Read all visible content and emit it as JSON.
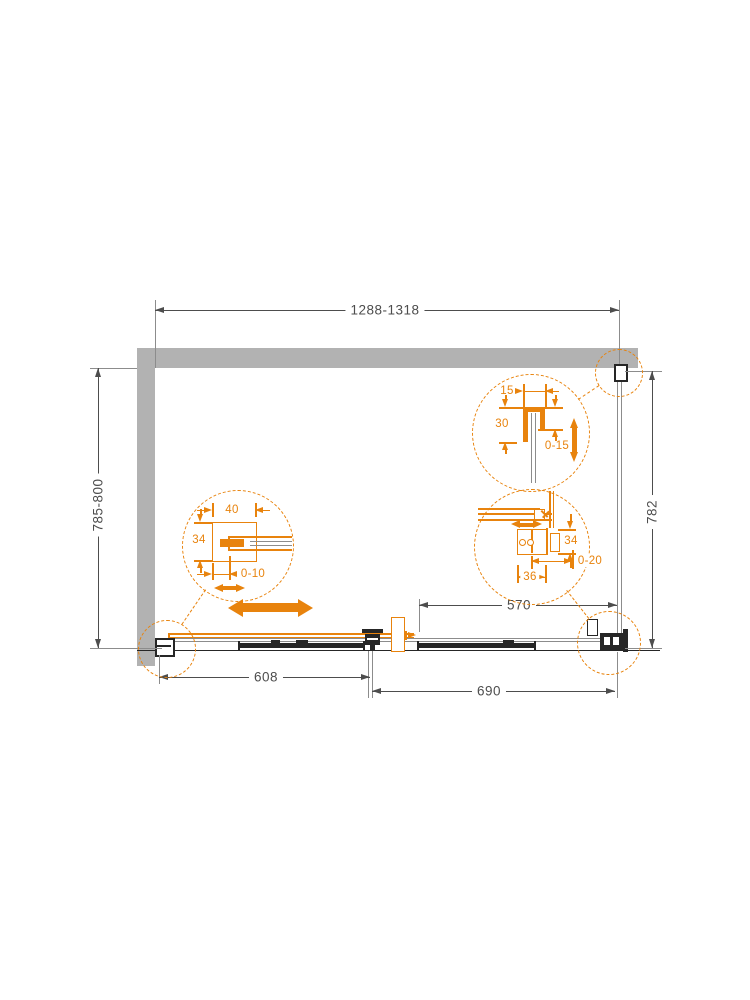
{
  "colors": {
    "accent": "#E8830D",
    "wall": "#B2B2B2",
    "line": "#262626",
    "dim": "#4D4D4D",
    "thin": "#8C8C8C"
  },
  "dimensions": {
    "overall_width": "1288-1318",
    "overall_depth": "785-800",
    "side_panel_depth": "782",
    "fixed_glass_width": "570",
    "door_section_width": "608",
    "panel_section_width": "690"
  },
  "detail_wall_profile": {
    "depth": "40",
    "width": "34",
    "adjustment": "0-10"
  },
  "detail_side_wall_profile": {
    "width": "15",
    "depth": "30",
    "adjustment": "0-15"
  },
  "detail_corner_connector": {
    "height": "34",
    "adjustment": "0-20",
    "width": "36"
  }
}
